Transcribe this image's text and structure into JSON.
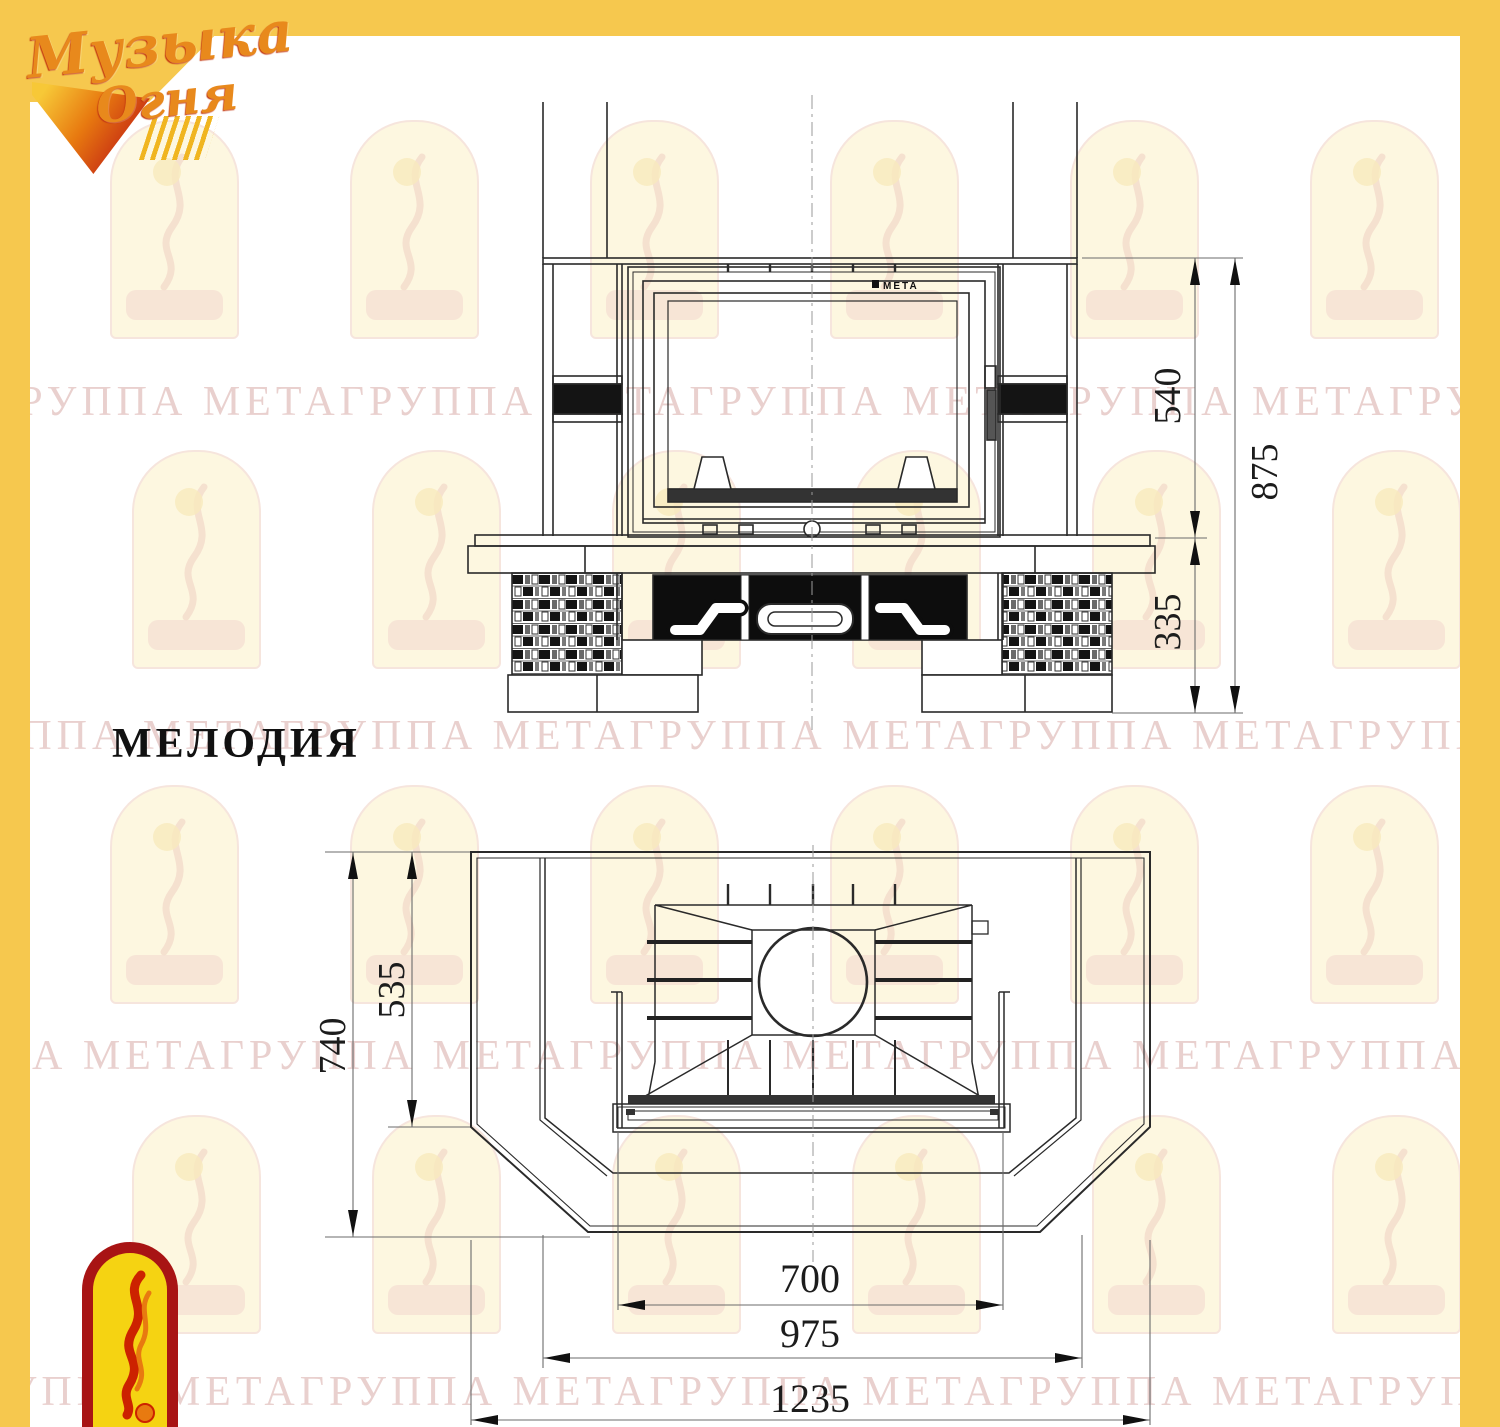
{
  "header": {
    "logo_line1": "Музыка",
    "logo_line2": "Огня"
  },
  "title": "МЕЛОДИЯ",
  "insert_brand": "МЕТА",
  "watermark": {
    "text": "ГРУППА МЕТА"
  },
  "views": {
    "front": {
      "dims": {
        "insert_height": "540",
        "total_height": "875",
        "base_height": "335"
      }
    },
    "plan": {
      "dims": {
        "depth_total": "740",
        "depth_inner": "535",
        "opening_width": "700",
        "body_width": "975",
        "total_width": "1235"
      }
    }
  },
  "colors": {
    "frame_yellow": "#f6c84e",
    "line": "#2a2a2a",
    "dimension": "#6b6b6b",
    "watermark_text": "#cb8e8a",
    "emblem_red": "#a81414",
    "emblem_yellow": "#f5d312",
    "logo_orange": "#e8891c"
  }
}
